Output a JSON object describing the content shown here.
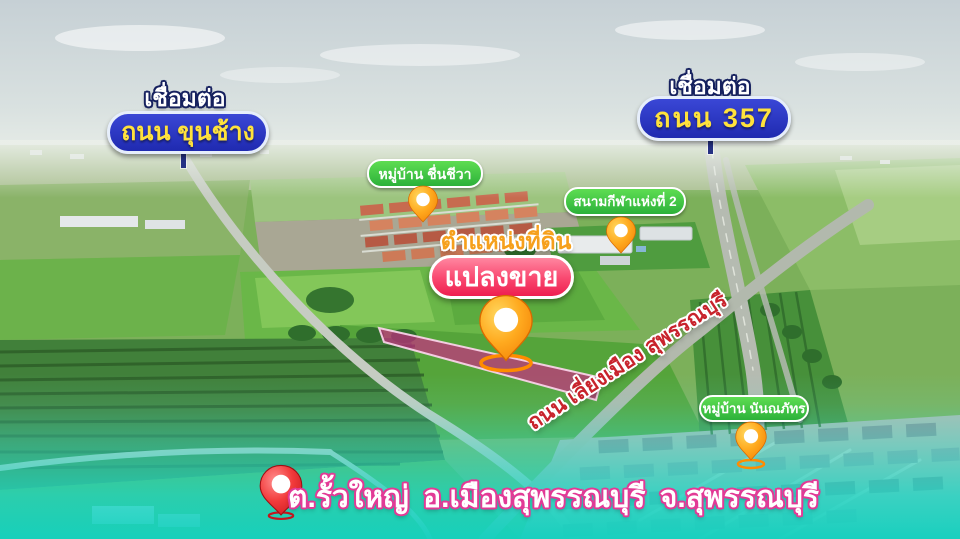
{
  "annotations": {
    "left_connector": {
      "label": "เชื่อมต่อ",
      "road_name": "ถนน ขุนช้าง"
    },
    "right_connector": {
      "label": "เชื่อมต่อ",
      "road_name": "ถนน 357"
    },
    "village_chuenchiwa": {
      "label": "หมู่บ้าน ชื่นชีวา"
    },
    "stadium": {
      "label": "สนามกีฬาแห่งที่ 2"
    },
    "land_position_caption": {
      "label": "ตำแหน่งที่ดิน"
    },
    "sale_plot_badge": {
      "label": "แปลงขาย"
    },
    "bypass_road": {
      "label": "ถนน เลี่ยงเมือง สุพรรณบุรี"
    },
    "village_nannaphat": {
      "label": "หมู่บ้าน นันณภัทร"
    },
    "address_caption": {
      "label": "ต.รั้วใหญ่ อ.เมืองสุพรรณบุรี จ.สุพรรณบุรี"
    }
  },
  "colors": {
    "sign_blue": "#2733c6",
    "sign_text_yellow": "#ffe23c",
    "village_pill_green": "#3fc94a",
    "sale_badge_pink": "#ee1e4f",
    "plot_highlight_magenta": "#d81f8c",
    "bypass_text_red": "#c8232c",
    "caption_gold": "#f6a01c",
    "address_outline_pink": "#e23a96",
    "bottom_overlay_teal": "#1ed2c1",
    "pin_orange": "#ff9d1f",
    "pin_red": "#e0161f"
  }
}
